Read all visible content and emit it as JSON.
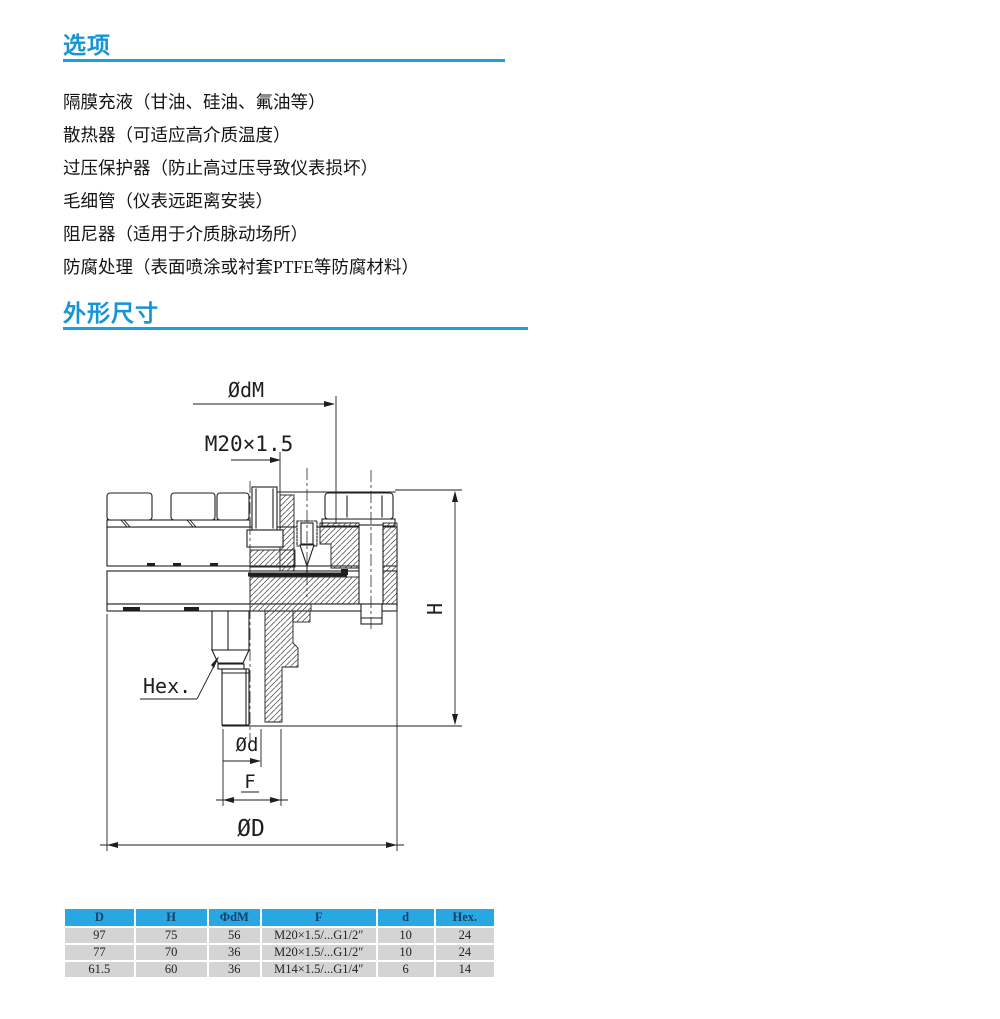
{
  "page": {
    "accent": "#1594d6",
    "rule_color": "#1c9fdd"
  },
  "options_section": {
    "title": "选项",
    "items": [
      "隔膜充液（甘油、硅油、氟油等）",
      "散热器（可适应高介质温度）",
      "过压保护器（防止高过压导致仪表损坏）",
      "毛细管（仪表远距离安装）",
      "阻尼器（适用于介质脉动场所）",
      "防腐处理（表面喷涂或衬套PTFE等防腐材料）"
    ]
  },
  "dimensions_section": {
    "title": "外形尺寸"
  },
  "drawing": {
    "labels": {
      "dia_dm": "ØdM",
      "thread": "M20×1.5",
      "height": "H",
      "hex": "Hex.",
      "dia_d": "Ød",
      "f": "F",
      "dia_big": "ØD"
    }
  },
  "table": {
    "headers": [
      "D",
      "H",
      "ΦdM",
      "F",
      "d",
      "Hex."
    ],
    "rows": [
      [
        "97",
        "75",
        "56",
        "M20×1.5/...G1/2″",
        "10",
        "24"
      ],
      [
        "77",
        "70",
        "36",
        "M20×1.5/...G1/2″",
        "10",
        "24"
      ],
      [
        "61.5",
        "60",
        "36",
        "M14×1.5/...G1/4″",
        "6",
        "14"
      ]
    ],
    "colors": {
      "header_bg": "#29a7e0",
      "header_text": "#17406b",
      "row_bg": "#d4d4d4"
    }
  }
}
